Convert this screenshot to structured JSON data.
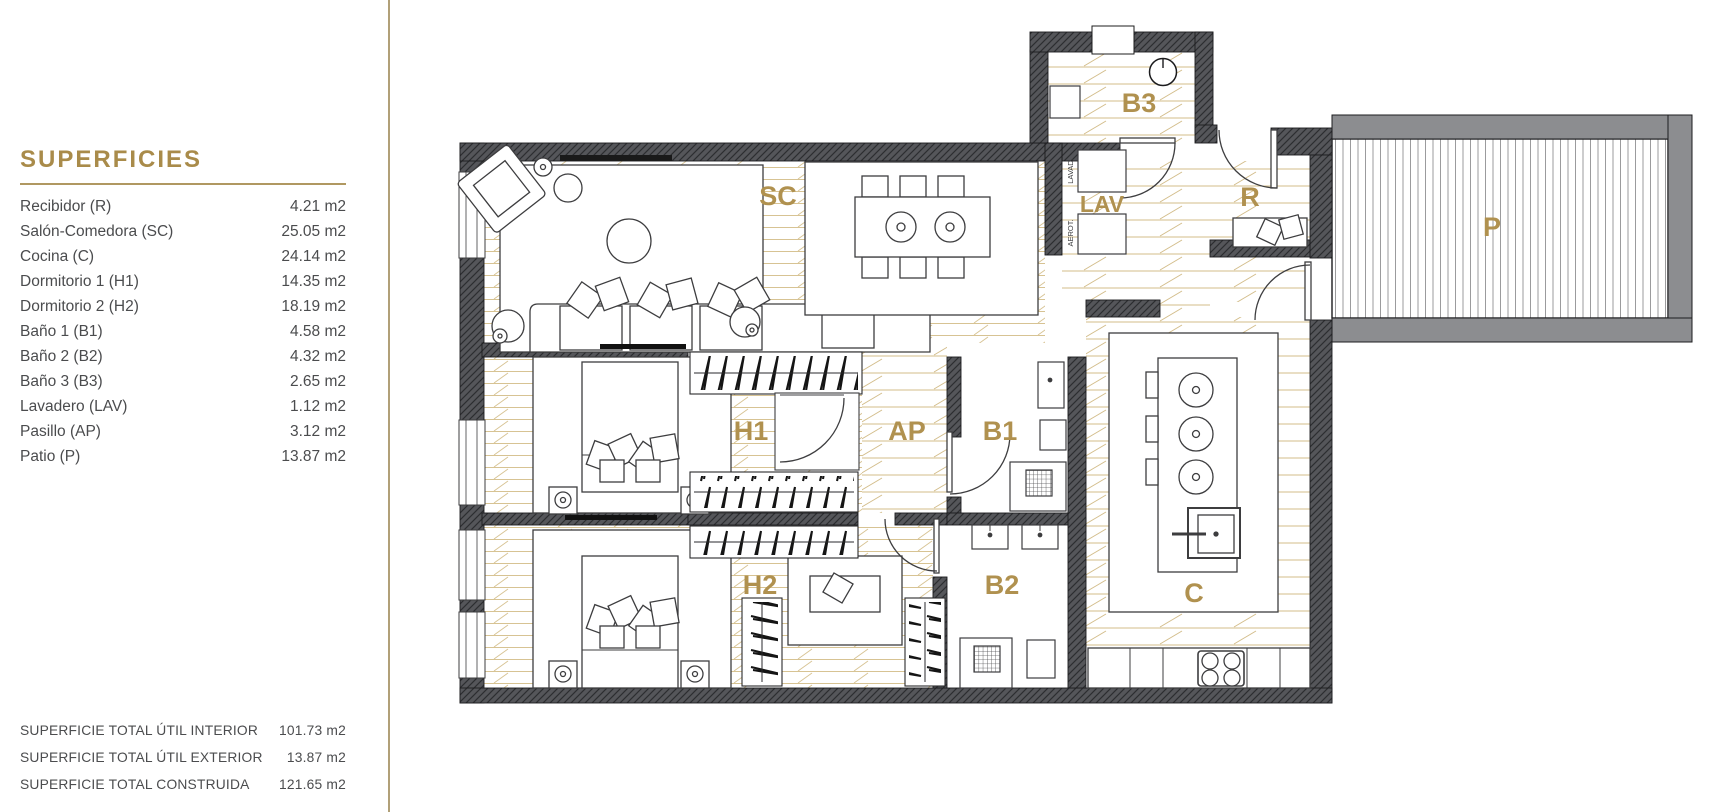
{
  "colors": {
    "accent_gold": "#a98b4a",
    "room_label_gold": "#b0914f",
    "wall_dark": "#55565a",
    "patio_wall_gray": "#8c8d90",
    "floor_line_tan": "#d7c393",
    "divider_tan": "#b1a078",
    "text_gray": "#4b4c4e"
  },
  "panel": {
    "title": "SUPERFICIES",
    "rows": [
      {
        "label": "Recibidor (R)",
        "value": "4.21 m2"
      },
      {
        "label": "Salón-Comedora (SC)",
        "value": "25.05 m2"
      },
      {
        "label": "Cocina (C)",
        "value": "24.14 m2"
      },
      {
        "label": "Dormitorio 1 (H1)",
        "value": "14.35 m2"
      },
      {
        "label": "Dormitorio 2 (H2)",
        "value": "18.19 m2"
      },
      {
        "label": "Baño 1  (B1)",
        "value": "4.58 m2"
      },
      {
        "label": "Baño 2  (B2)",
        "value": "4.32 m2"
      },
      {
        "label": "Baño 3  (B3)",
        "value": "2.65 m2"
      },
      {
        "label": "Lavadero (LAV)",
        "value": "1.12 m2"
      },
      {
        "label": "Pasillo (AP)",
        "value": "3.12 m2"
      },
      {
        "label": "Patio (P)",
        "value": "13.87 m2"
      }
    ],
    "totals": [
      {
        "label": "SUPERFICIE TOTAL ÚTIL INTERIOR",
        "value": "101.73 m2"
      },
      {
        "label": "SUPERFICIE TOTAL ÚTIL EXTERIOR",
        "value": "13.87 m2"
      },
      {
        "label": "SUPERFICIE TOTAL CONSTRUIDA",
        "value": "121.65 m2"
      }
    ]
  },
  "floorplan": {
    "labels": {
      "sc": "SC",
      "b3": "B3",
      "lav": "LAV",
      "r": "R",
      "p": "P",
      "h1": "H1",
      "ap": "AP",
      "b1": "B1",
      "h2": "H2",
      "b2": "B2",
      "c": "C"
    },
    "appliances": {
      "washer": "LAVAD.",
      "aerot": "AEROT."
    }
  }
}
